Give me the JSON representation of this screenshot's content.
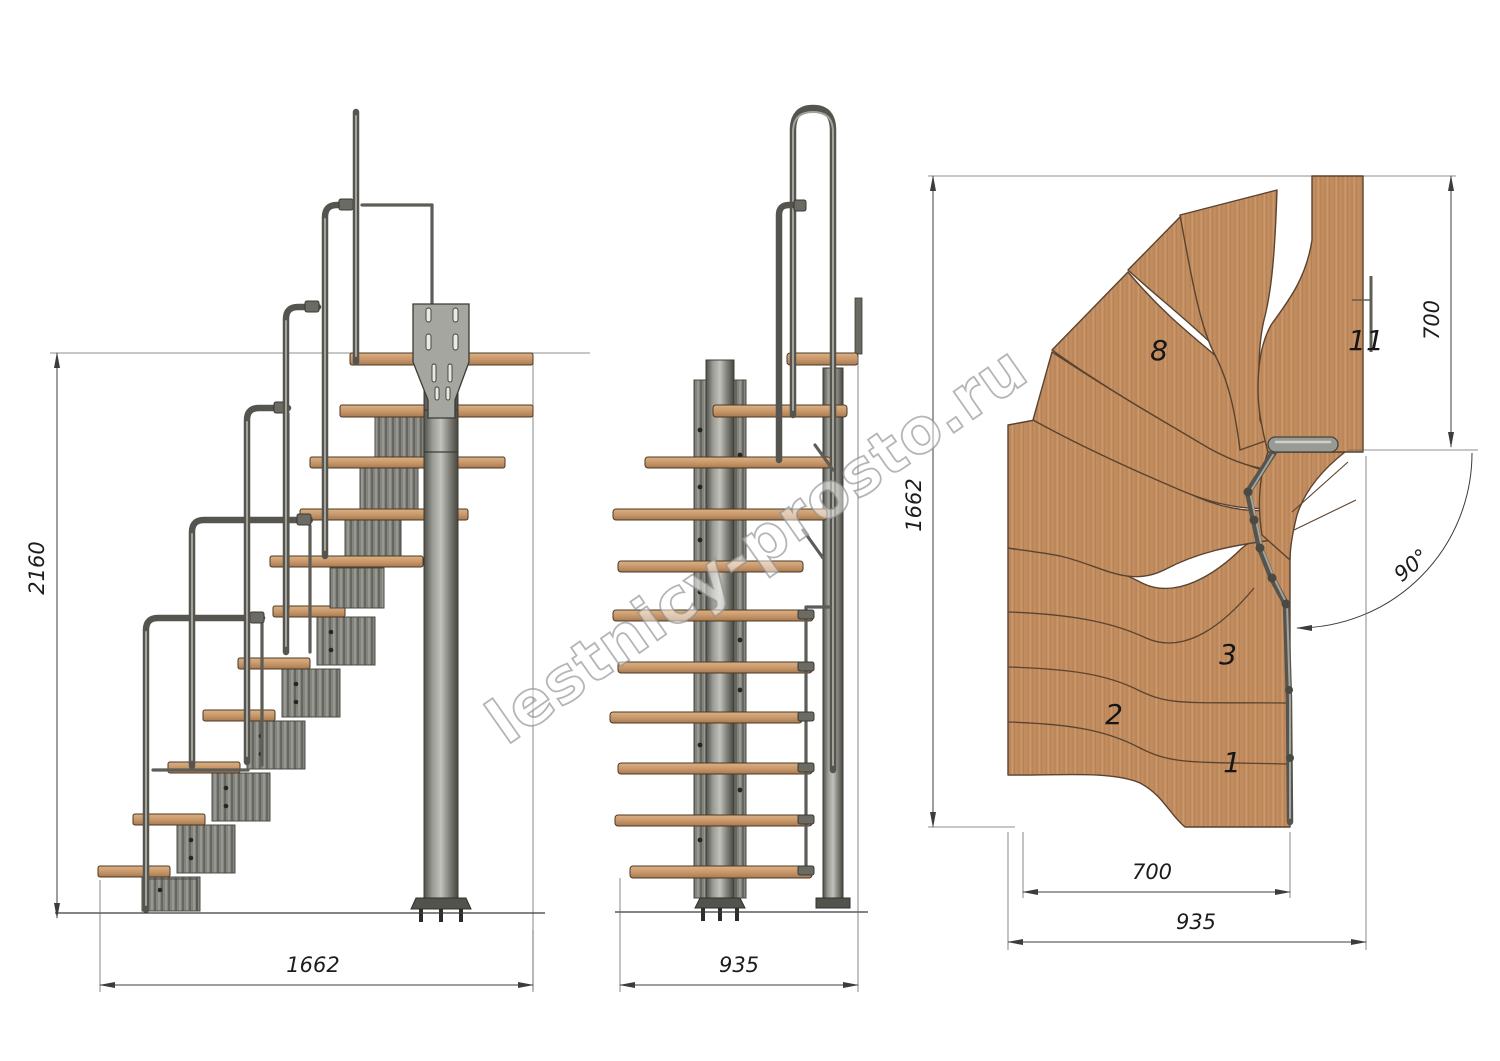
{
  "watermark": {
    "text": "lestnicy-prosto.ru"
  },
  "views": {
    "side": {
      "height_mm": "2160",
      "run_length_mm": "1662"
    },
    "front": {
      "width_mm": "935"
    },
    "plan": {
      "length_mm": "1662",
      "upper_flight_depth_mm": "700",
      "flight_width_mm": "700",
      "overall_width_mm": "935",
      "turn_angle": "90°",
      "step_numbers": {
        "step1": "1",
        "step2": "2",
        "step3": "3",
        "step8": "8",
        "step11": "11"
      }
    }
  },
  "colors": {
    "wood": "#c18c5f",
    "metal": "#8f8f89",
    "dimension_line": "#3c3c3c",
    "background": "#ffffff"
  }
}
